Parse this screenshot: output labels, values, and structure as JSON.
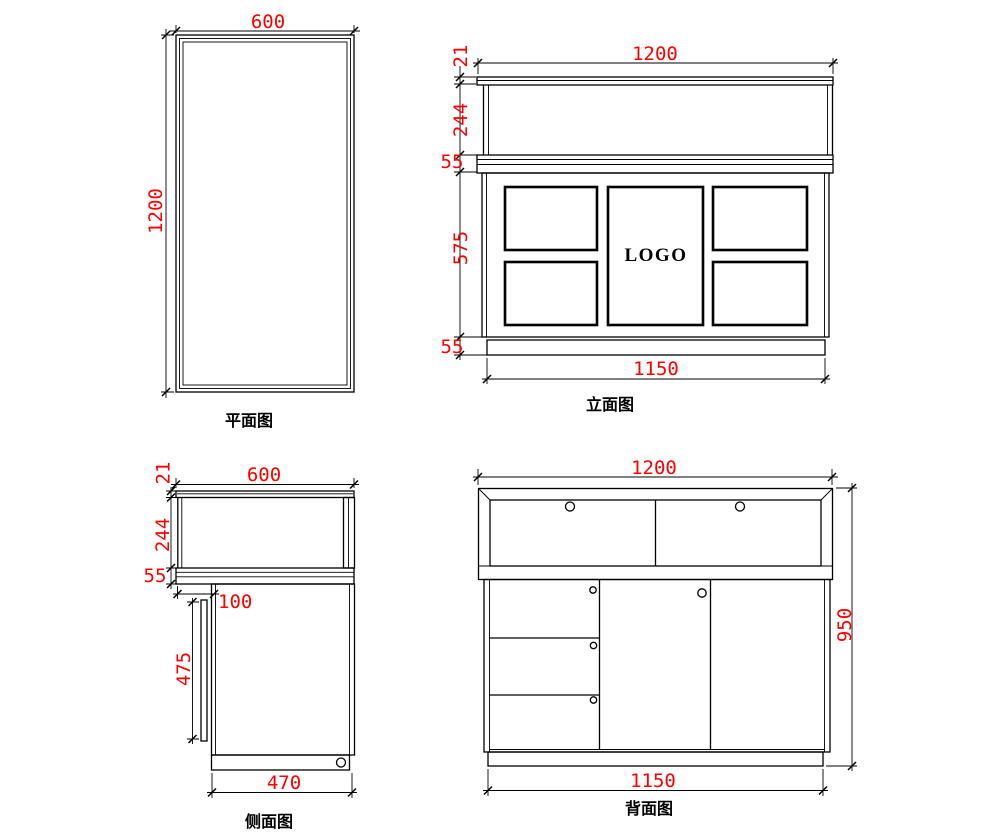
{
  "colors": {
    "background": "#ffffff",
    "line": "#000000",
    "dimension": "#fe0000"
  },
  "plan": {
    "label": "平面图",
    "dim_width": "600",
    "dim_height": "1200"
  },
  "elevation": {
    "label": "立面图",
    "logo": "LOGO",
    "dim_width_top": "1200",
    "dim_cap": "21",
    "dim_glass": "244",
    "dim_counter": "55",
    "dim_body": "575",
    "dim_base": "55",
    "dim_width_bottom": "1150"
  },
  "side": {
    "label": "侧面图",
    "dim_width_top": "600",
    "dim_cap": "21",
    "dim_glass": "244",
    "dim_counter": "55",
    "dim_inset": "100",
    "dim_back_panel": "475",
    "dim_width_bottom": "470"
  },
  "back": {
    "label": "背面图",
    "dim_width_top": "1200",
    "dim_height": "950",
    "dim_width_bottom": "1150"
  }
}
